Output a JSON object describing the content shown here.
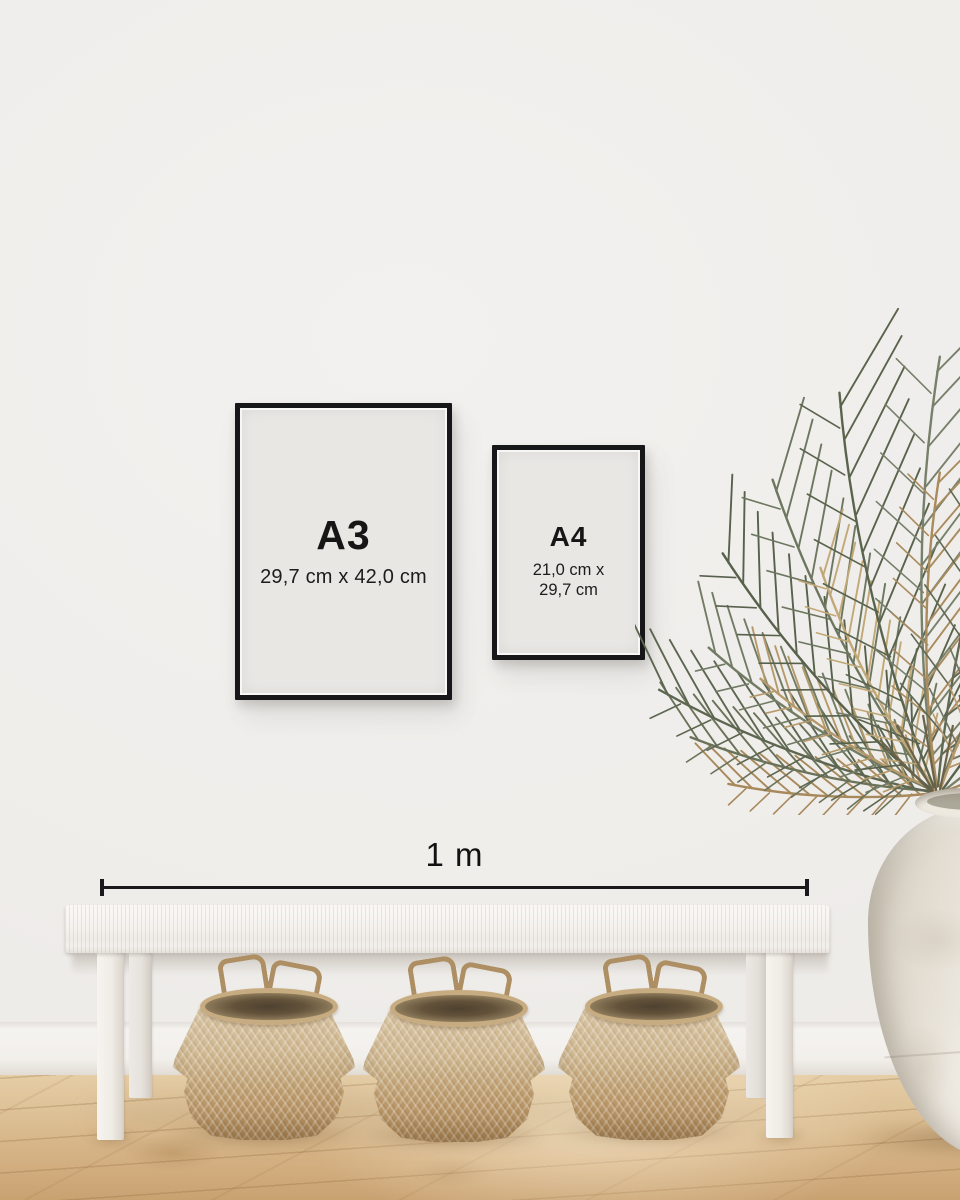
{
  "frames": {
    "a3": {
      "label": "A3",
      "dimensions": "29,7 cm x 42,0 cm"
    },
    "a4": {
      "label": "A4",
      "dimensions_line1": "21,0 cm x",
      "dimensions_line2": "29,7 cm"
    }
  },
  "scale_bar": {
    "label": "1 m"
  },
  "colors": {
    "wall": "#efedea",
    "frame_border": "#17171a",
    "frame_paper": "#e9e7e4",
    "text": "#141414",
    "floor_light": "#e5cda6",
    "floor_dark": "#c9a272",
    "baseboard": "#f5f3f0",
    "bench_white": "#f6f4f0",
    "basket_tan": "#c0a377",
    "basket_rim_dark": "#5e4f39",
    "vase_white": "#f1ede6",
    "leaf_green": "#5c6650",
    "leaf_tan": "#b2935f"
  }
}
